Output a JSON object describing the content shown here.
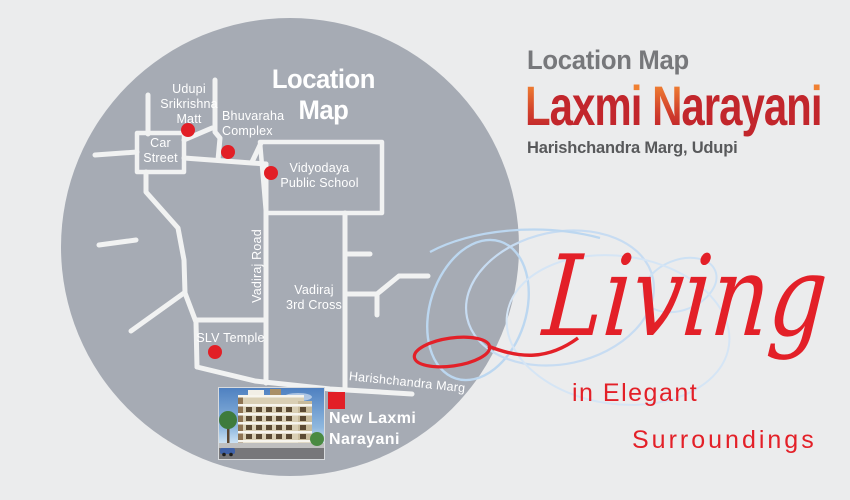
{
  "map": {
    "title": "Location Map",
    "labels": {
      "udupi_srikrishna_matt": "Udupi\nSrikrishna\nMatt",
      "bhuvaraha_complex": "Bhuvaraha\nComplex",
      "car_street": "Car\nStreet",
      "vidyodaya_public_school": "Vidyodaya\nPublic School",
      "vadiraj_road": "Vadiraj Road",
      "vadiraj_3rd_cross": "Vadiraj\n3rd Cross",
      "slv_temple": "SLV Temple",
      "harishchandra_marg": "Harishchandra Marg",
      "new_laxmi_narayani": "New Laxmi\nNarayani"
    },
    "markers": [
      {
        "name": "udupi-srikrishna-matt-dot"
      },
      {
        "name": "bhuvaraha-complex-dot"
      },
      {
        "name": "vidyodaya-public-school-dot"
      },
      {
        "name": "slv-temple-dot"
      },
      {
        "name": "new-laxmi-narayani-square"
      }
    ]
  },
  "header": {
    "kicker": "Location Map",
    "brand_full": "Laxmi Narayani",
    "brand_segments": [
      {
        "text": "L",
        "style": "grad-cap"
      },
      {
        "text": "axm",
        "style": "red"
      },
      {
        "text": "i",
        "style": "i-dot"
      },
      {
        "text": " ",
        "style": "red"
      },
      {
        "text": "N",
        "style": "grad-cap"
      },
      {
        "text": "arayan",
        "style": "red"
      },
      {
        "text": "i",
        "style": "i-dot"
      }
    ],
    "address": "Harishchandra Marg, Udupi"
  },
  "tagline": {
    "script_word": "Living",
    "line2": "in Elegant",
    "line3": "Surroundings"
  },
  "colors": {
    "background": "#ebeced",
    "circle_gray": "#a6abb4",
    "road_white": "#f1f2f2",
    "marker_red": "#e21f26",
    "accent_red": "#e32028",
    "brand_red": "#c2262c",
    "brand_orange": "#f08032",
    "kicker_gray": "#77787b",
    "address_gray": "#58595b",
    "swirl_blue": "#bcd7f0"
  }
}
